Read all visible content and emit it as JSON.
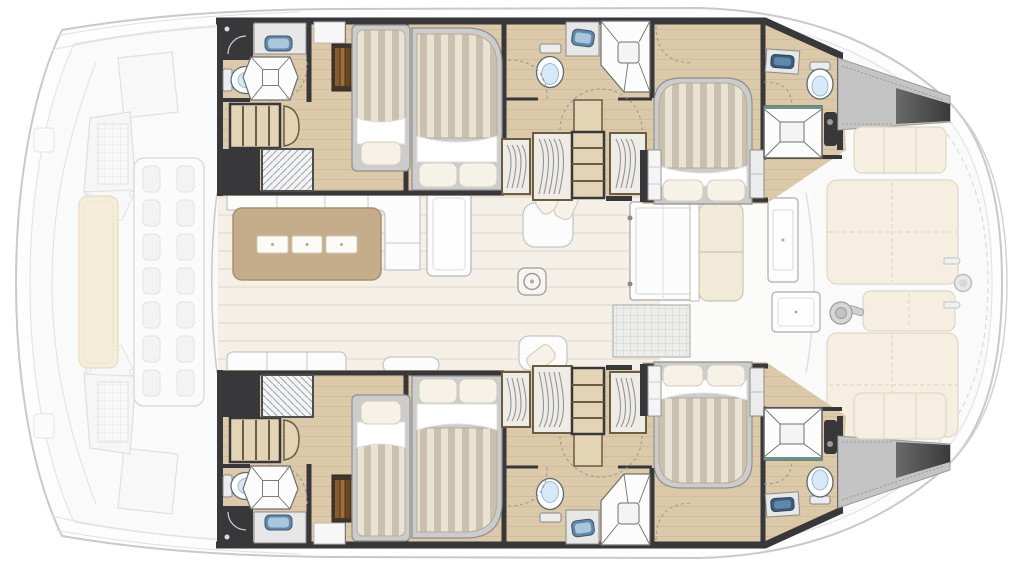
{
  "title": "Catamaran yacht accommodation floor plan, top view, bow at left",
  "colors": {
    "page_bg": "#ffffff",
    "hull_fill": "#fdfdfd",
    "hull_line": "#c9c9c9",
    "wood": "#dbc9a9",
    "wood_grain": "#cfbd9b",
    "wood_step": "#e3d4b6",
    "wood_dark": "#6b5d45",
    "wall": "#38383a",
    "counter": "#e7e7e7",
    "sink_blue": "#5f88ab",
    "sink_blue_light": "#a9c7dc",
    "sink_blue_dark": "#3c5e7e",
    "toilet_seat": "#d7e9f6",
    "stripe_a": "#cbc0ae",
    "stripe_b": "#e9e3d5",
    "sheet": "#ffffff",
    "pillow": "#f6f2e8",
    "pillow_line": "#d4cdbd",
    "bedframe": "#cccccc",
    "locker": "#efece5",
    "hanger": "#8f959d",
    "saloon_floor": "#f4f0e7",
    "plank_line": "#e8e1d1",
    "table_wood": "#c5ac8b",
    "table_edge": "#a98f6d",
    "placemat": "#fcfbf8",
    "sofa": "#fcfcfc",
    "sofa_line": "#c7c7c7",
    "cushion": "#f2ead8",
    "cushion_line": "#cfc4aa",
    "sunpad": "#f6efe1",
    "sunpad_line": "#e0d8c6",
    "mat": "#ededec",
    "mat_grid": "#c8c8c8",
    "door_dash": "#9a9a9a",
    "shadow_dark": "#4a4a4a",
    "shower_accent": "#6a9286",
    "book_a": "#8a5a30",
    "book_b": "#6e4522",
    "book_c": "#a06c38"
  },
  "areas": {
    "bow_deck": [
      "trampoline",
      "sun bench",
      "mast foot"
    ],
    "each_hull": [
      "forward head",
      "forward single-bed cabin",
      "double-bed cabin",
      "mid head",
      "wardrobe lockers",
      "companionway stairs",
      "aft island-bed cabin",
      "aft head"
    ],
    "saloon": [
      "U-shaped sofa",
      "dining table",
      "three placemats",
      "sideboard",
      "chaise longue",
      "bench sofa",
      "floor hatch"
    ],
    "cockpit": [
      "sliding glass door",
      "bench seat",
      "doormat",
      "table",
      "console"
    ],
    "aft_deck": [
      "quarter bench",
      "sun pads",
      "winch",
      "transom fitting",
      "stern shadow wedge"
    ]
  },
  "counts": {
    "beds": 6,
    "heads": 6,
    "placemats": 3,
    "sun_pads": 3
  }
}
